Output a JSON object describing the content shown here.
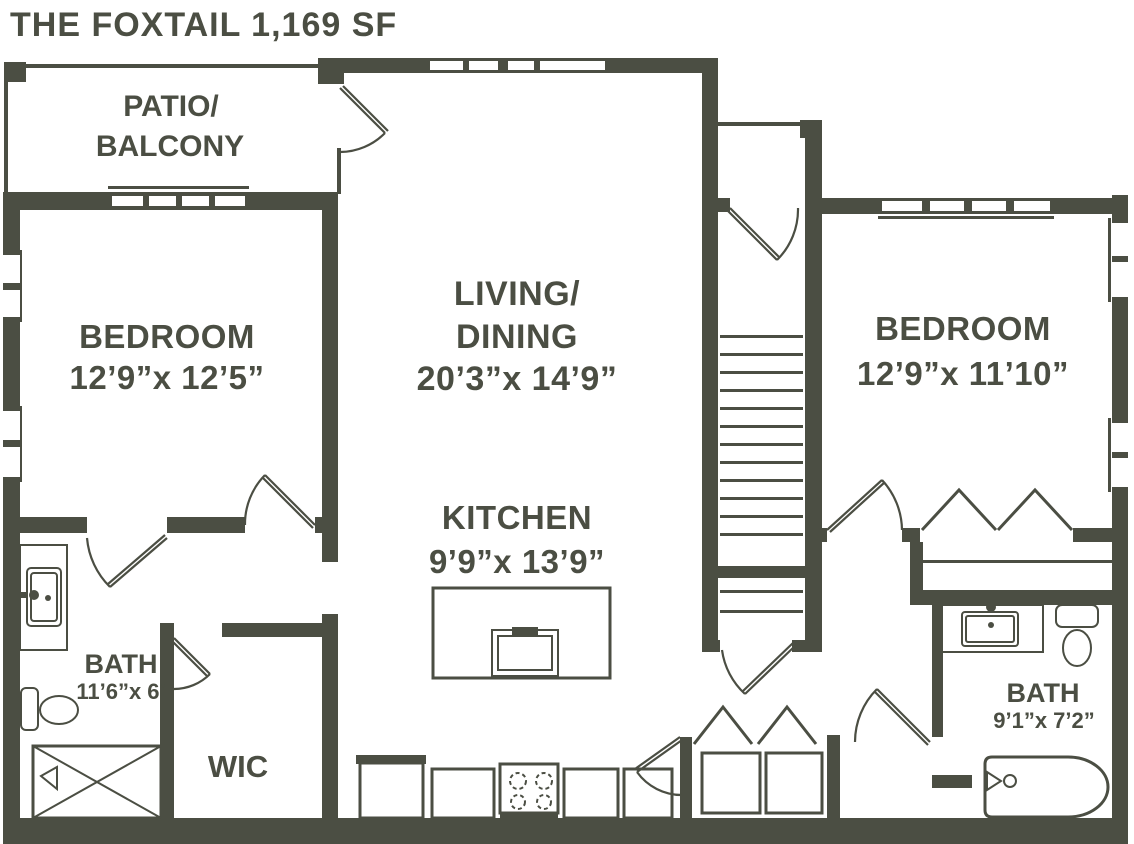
{
  "title": "THE FOXTAIL 1,169 SF",
  "colors": {
    "wall": "#4b4e43",
    "background": "#ffffff"
  },
  "rooms": {
    "patio": {
      "line1": "PATIO/",
      "line2": "BALCONY"
    },
    "bedroom_left": {
      "name": "BEDROOM",
      "dims": "12’9”x 12’5”"
    },
    "living_dining": {
      "line1": "LIVING/",
      "line2": "DINING",
      "dims": "20’3”x 14’9”"
    },
    "kitchen": {
      "name": "KITCHEN",
      "dims": "9’9”x 13’9”"
    },
    "bedroom_right": {
      "name": "BEDROOM",
      "dims": "12’9”x 11’10”"
    },
    "bath_left": {
      "name": "BATH",
      "dims": "11’6”x 6’"
    },
    "wic": {
      "name": "WIC"
    },
    "bath_right": {
      "name": "BATH",
      "dims": "9’1”x 7’2”"
    }
  },
  "fixtures": [
    "staircase",
    "kitchen-island-sink",
    "range-4-burner",
    "refrigerator",
    "washer",
    "dryer",
    "toilet",
    "vanity-sink",
    "bathtub",
    "shower",
    "closet-rod",
    "bifold-doors"
  ]
}
